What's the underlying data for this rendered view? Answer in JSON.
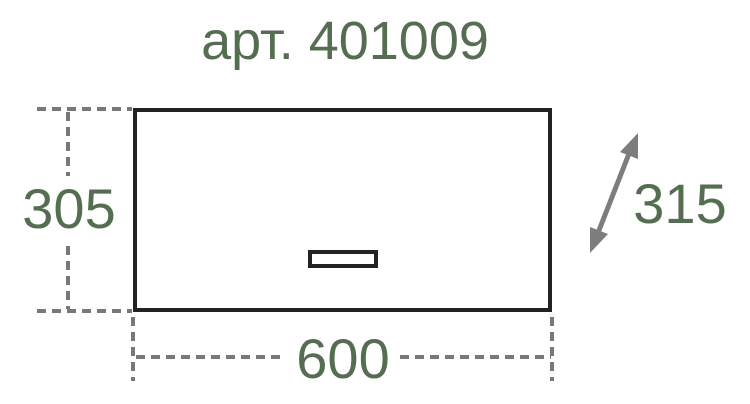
{
  "title": "арт. 401009",
  "diagram": {
    "height_label": "305",
    "width_label": "600",
    "depth_label": "315"
  },
  "colors": {
    "text_green": "#556e51",
    "outline_dark": "#232323",
    "dash_gray": "#787878",
    "arrow_gray": "#7d7d7d",
    "background": "#ffffff"
  }
}
